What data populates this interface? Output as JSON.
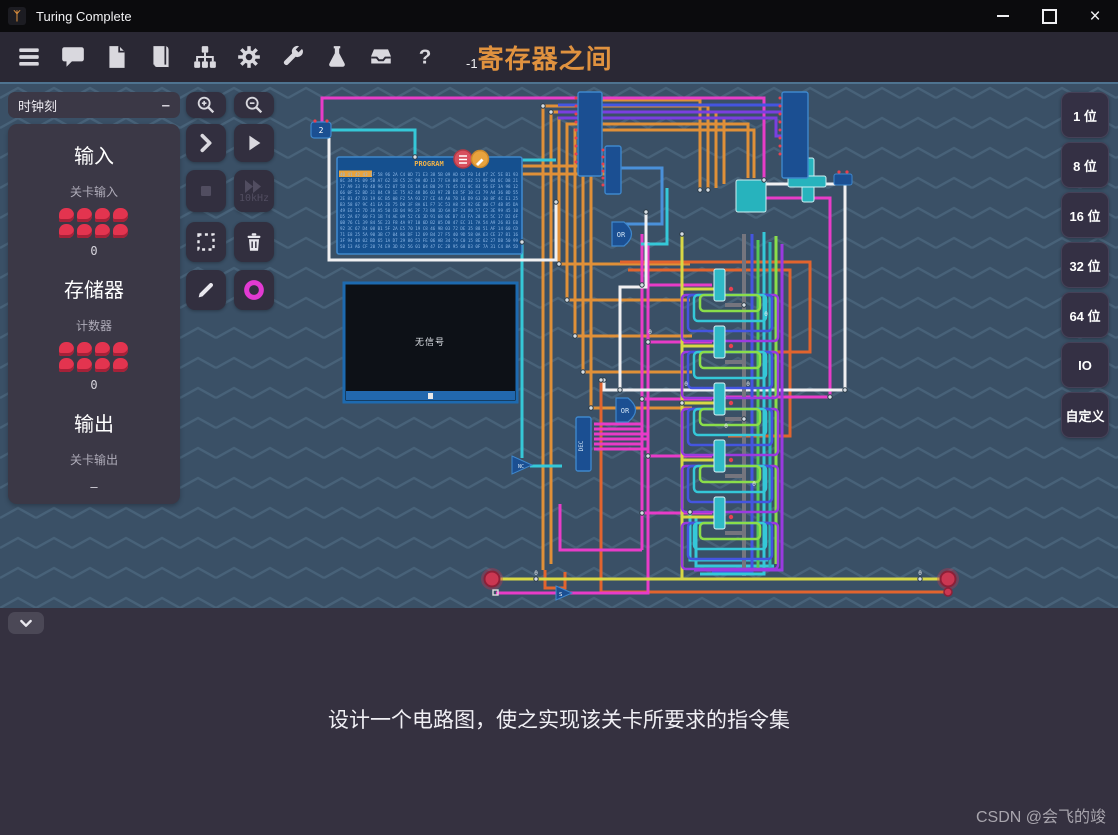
{
  "window": {
    "title": "Turing Complete"
  },
  "toolbar": {
    "level_id": "-1",
    "level_title": "寄存器之间",
    "help_label": "?"
  },
  "left_panel": {
    "clock_label": "时钟刻",
    "clock_collapse": "–",
    "input_heading": "输入",
    "input_label": "关卡输入",
    "input_value": "0",
    "memory_heading": "存储器",
    "counter_label": "计数器",
    "counter_value": "0",
    "output_heading": "输出",
    "output_label": "关卡输出",
    "output_value": "–"
  },
  "tools": {
    "fast_label": "10kHz"
  },
  "right_panel": {
    "buttons": [
      "1 位",
      "8 位",
      "16 位",
      "32 位",
      "64 位",
      "IO",
      "自定义"
    ]
  },
  "bottom_panel": {
    "objective": "设计一个电路图，使之实现该关卡所要求的指令集",
    "watermark": "CSDN @会飞的竣"
  },
  "canvas": {
    "program": {
      "title": "PROGRAM",
      "rows": [
        "40 41 42 43 1F 58 96 2A C4 0D 71 E3 38 5B 09 AD 62 F0 14 87 2C 5E B1 93",
        "8C 34 F1 09 5B A7 62 18 C5 2E 90 4D 13 77 EA 08 36 B2 51 9F 04 6C D8 21",
        "17 A9 33 F0 4B 96 E2 07 5D C8 1A 64 B0 29 7E 45 D1 0C 83 56 EF 3A 98 12",
        "66 0F 52 BD 31 84 C9 1E 75 A2 48 D6 03 97 2B E8 5F 10 C3 79 A4 36 8D 55",
        "2E 81 47 D3 19 6C B5 08 F2 5A 93 27 CE 44 A0 7B 16 D9 63 30 8F 4C E1 25",
        "B3 58 07 9C 41 EA 26 75 D0 3F 8A 61 F7 1C 53 A8 35 92 6E 00 C7 4B 85 DA",
        "49 E6 12 7D 38 A5 50 CB 04 96 2F 73 B8 1D 6A DF 24 80 57 C2 3E 99 45 10",
        "D5 2A 87 60 F3 1B 74 AE 09 52 C6 3D 91 68 0E B7 43 FA 28 85 5C 17 D2 6F",
        "0B 76 C1 39 84 5E 23 F8 4A 97 10 6D B2 05 D8 47 EC 31 7A 54 A9 26 83 E0",
        "92 3C 67 D4 08 B1 5F 2A E5 70 19 C8 46 9B 03 72 DE 35 88 51 AF 14 60 CD",
        "71 E8 25 5A 90 3B C7 04 86 DF 12 69 B4 27 F5 40 9D 58 0A 63 CE 37 81 16",
        "3F 94 48 02 BD 65 1A D7 29 80 53 FE 06 AB 34 79 C0 15 8E 62 27 DB 50 99",
        "58 13 A6 CF 20 74 E9 3D 82 56 01 B9 47 EC 2B 95 68 D3 0F 7A 31 C4 8A 5D"
      ]
    },
    "screen": {
      "no_signal": "无信号"
    },
    "labels": {
      "dec": "DEC",
      "or1": "OR",
      "or2": "OR",
      "nc": "NC",
      "s": "S",
      "two": "2",
      "zero": "0"
    }
  },
  "colors": {
    "accent_orange": "#e0923f",
    "wire_orange": "#e09038",
    "wire_red_orange": "#e2642e",
    "wire_magenta": "#e83cc8",
    "wire_purple": "#7a3fe0",
    "wire_blue": "#4455e0",
    "wire_cyan": "#35c8d8",
    "wire_green": "#55c855",
    "wire_lime": "#8ade4a",
    "wire_yellow": "#d8d845",
    "wire_white": "#f0f0f2",
    "wire_gray": "#75757e",
    "node_red": "#c8314e",
    "ring_magenta": "#e23ad2",
    "chip_blue": "#1b4f92",
    "teal_component": "#27b3bd"
  }
}
